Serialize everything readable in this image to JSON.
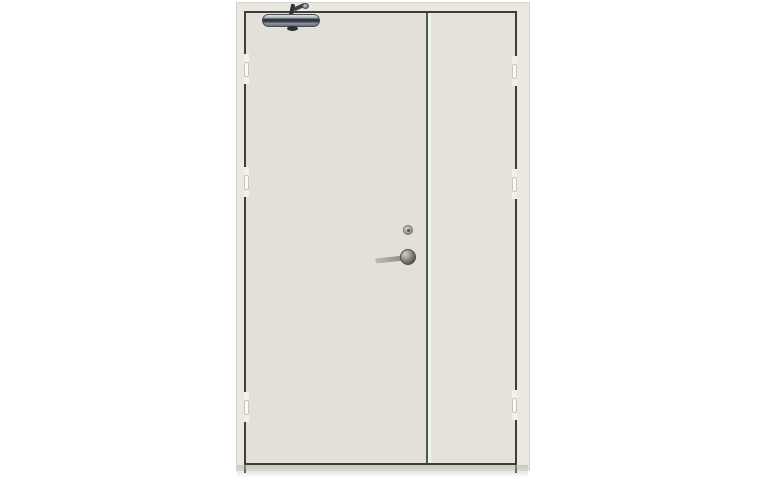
{
  "image": {
    "type": "product-photo",
    "subject": "Beige unequal double-leaf steel fire door with overhead door closer, lever handle and lock cylinder, on a plain white background"
  },
  "colors": {
    "background": "#ffffff",
    "frame": "#ebe8e1",
    "frame_edge": "#d6d4cc",
    "panel": "#e3e0d9",
    "panel_right": "#e5e2db",
    "outline": "#3e3e36",
    "stile": "#4e5a4a",
    "stile_highlight": "#edf1e6",
    "hinge_notch": "#f2f0ea",
    "hinge_knuckle": "#fbfaf6",
    "hinge_edge": "#c7c5bd",
    "closer_dark": "#2b2f38",
    "closer_mid": "#8d939c",
    "closer_light": "#dfe2e6",
    "metal_light": "#c9c8c2",
    "metal_dark": "#5a5953",
    "shadow": "#bab8b2"
  },
  "door": {
    "leaf_count": 2,
    "hinge_count_per_side": 3,
    "parts": {
      "assembly": "Double-leaf door assembly",
      "frame": "Door frame",
      "left_leaf": "Wide active leaf",
      "right_leaf": "Narrow inactive leaf",
      "meeting_stile": "Meeting stile between leaves",
      "closer_body": "Overhead door closer body",
      "closer_arm": "Door closer arm",
      "cylinder": "Lock cylinder",
      "handle": "Lever handle",
      "hinge": "Hinge",
      "shadow": "Floor shadow"
    }
  }
}
